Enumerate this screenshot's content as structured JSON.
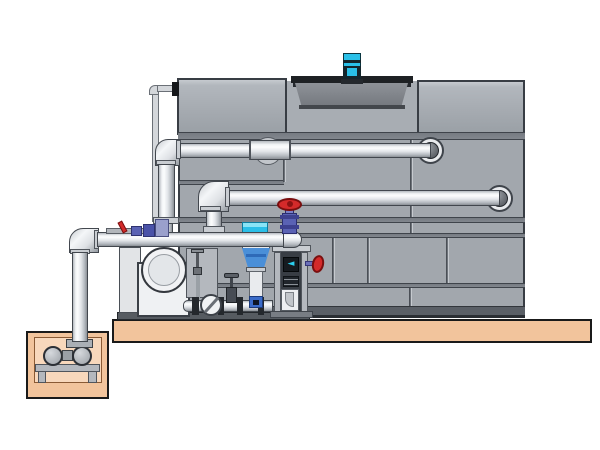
{
  "diagram": {
    "kind": "engineering-illustration",
    "subject": "cooling-tower-with-side-stream-filtration-pump-skid-and-sump",
    "canvas": {
      "width": 600,
      "height": 450
    }
  },
  "palette": {
    "background": "#ffffff",
    "slab_tan": "#f2c49c",
    "pit_inner_tan": "#f8d8bc",
    "tower_panel": "#a2a7ad",
    "tower_band": "#82878e",
    "tower_seam": "#3f444b",
    "tower_base": "#5a5f66",
    "fan_drum": "#83878d",
    "fan_plate": "#1e2124",
    "motor_cyan": "#2ac0e8",
    "motor_dark": "#15262c",
    "pipe_outline": "#42474e",
    "valve_red": "#d42a2a",
    "valve_blue": "#5a62b4",
    "separator_blue": "#4a8fd8",
    "separator_cyan": "#2bbfe8",
    "equipment_white": "#eff1f3",
    "steel_dark": "#31363c"
  },
  "icons": {
    "separator_logo_glyph": "◄"
  },
  "components": {
    "foundation": [
      "concrete-slab",
      "sump-pit",
      "sump-pump",
      "pump-stand"
    ],
    "tower": [
      "left-top-casing",
      "right-top-casing",
      "fan-cowl",
      "fan-motor",
      "paneled-body",
      "basin-base"
    ],
    "piping": [
      "upper-supply-pipe",
      "lower-return-pipe",
      "suction-header",
      "sump-riser",
      "makeup-line",
      "wall-port-flanges"
    ],
    "skid": [
      "centrifugal-pump",
      "gauge-panel",
      "manifold-pipe",
      "check-valve",
      "gate-valve",
      "cyclone-separator",
      "control-column",
      "baseplate"
    ],
    "valves": [
      "header-gate-valve-red",
      "separator-side-valve-red",
      "chemical-feed-valve-red"
    ]
  }
}
